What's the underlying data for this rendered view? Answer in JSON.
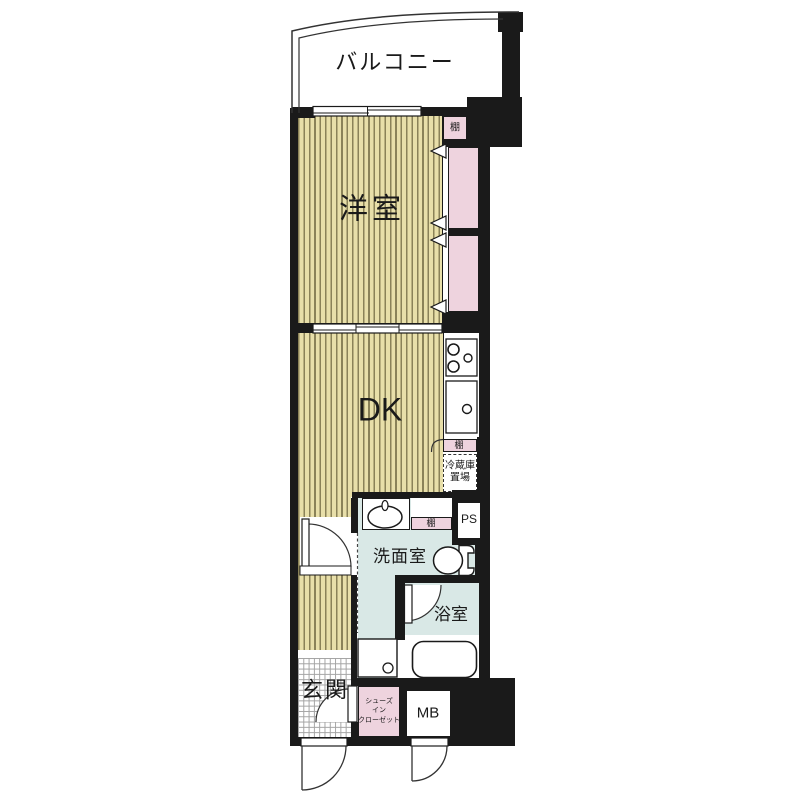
{
  "floorplan": {
    "balcony_label": "バルコニー",
    "western_room_label": "洋室",
    "shelf_top_label": "棚",
    "dk_label": "DK",
    "kitchen_shelf_label": "棚",
    "fridge_label_line1": "冷蔵庫",
    "fridge_label_line2": "置場",
    "ps_label": "PS",
    "washroom_shelf_label": "棚",
    "washroom_label": "洗面室",
    "bathroom_label": "浴室",
    "entrance_label": "玄関",
    "shoe_closet_line1": "シューズ",
    "shoe_closet_line2": "イン",
    "shoe_closet_line3": "クローゼット",
    "meter_box_label": "MB",
    "colors": {
      "wall": "#1a1a1a",
      "flooring": "#e8dfa9",
      "flooring_stripe": "#8a8258",
      "closet_pink": "#eed3de",
      "wet_area_blue": "#d9e8e6"
    }
  }
}
